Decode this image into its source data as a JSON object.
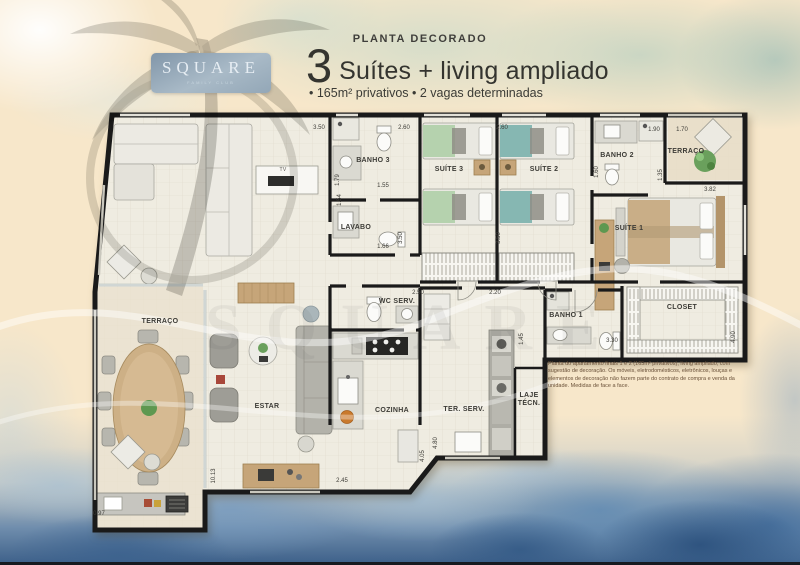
{
  "logo": {
    "brand": "SQUARE",
    "tagline": "FAMILY CLUB"
  },
  "header": {
    "kicker": "PLANTA DECORADO",
    "big_number": "3",
    "title": "Suítes + living ampliado",
    "features": "• 165m² privativos • 2 vagas determinadas"
  },
  "watermark": {
    "text": "SQUARE"
  },
  "colors": {
    "wall": "#1a1a1a",
    "floor": "#efece1",
    "badge": "#8a9cae",
    "water_blue": "#5d8cb8",
    "wood": "#c6a579",
    "suite3_accent": "#b5d2ae",
    "suite2_accent": "#86b7b2"
  },
  "plan": {
    "rooms": [
      {
        "label": "TERRAÇO",
        "x": 160,
        "y": 322
      },
      {
        "label": "ESTAR",
        "x": 267,
        "y": 407
      },
      {
        "label": "COZINHA",
        "x": 392,
        "y": 411
      },
      {
        "label": "TER. SERV.",
        "x": 464,
        "y": 410
      },
      {
        "label": "LAJE\nTÉCN.",
        "x": 529,
        "y": 400
      },
      {
        "label": "WC SERV.",
        "x": 397,
        "y": 302
      },
      {
        "label": "BANHO 1",
        "x": 566,
        "y": 316
      },
      {
        "label": "BANHO 3",
        "x": 373,
        "y": 161
      },
      {
        "label": "LAVABO",
        "x": 356,
        "y": 228
      },
      {
        "label": "SUÍTE 3",
        "x": 449,
        "y": 170
      },
      {
        "label": "SUÍTE 2",
        "x": 544,
        "y": 170
      },
      {
        "label": "BANHO 2",
        "x": 617,
        "y": 156
      },
      {
        "label": "SUÍTE 1",
        "x": 629,
        "y": 229
      },
      {
        "label": "TERRAÇO",
        "x": 686,
        "y": 152
      },
      {
        "label": "CLOSET",
        "x": 682,
        "y": 308
      },
      {
        "label": "TV",
        "x": 283,
        "y": 171,
        "small": true
      }
    ],
    "dimensions": [
      {
        "v": "3.50",
        "x": 319,
        "y": 128
      },
      {
        "v": "2.60",
        "x": 404,
        "y": 128
      },
      {
        "v": "2.60",
        "x": 502,
        "y": 128
      },
      {
        "v": "1.90",
        "x": 654,
        "y": 130
      },
      {
        "v": "1.70",
        "x": 682,
        "y": 130
      },
      {
        "v": "1.55",
        "x": 383,
        "y": 186
      },
      {
        "v": "1.79",
        "x": 338,
        "y": 180,
        "vert": true
      },
      {
        "v": "1.54",
        "x": 340,
        "y": 200,
        "vert": true
      },
      {
        "v": "1.66",
        "x": 383,
        "y": 247
      },
      {
        "v": "3.50",
        "x": 401,
        "y": 238,
        "vert": true
      },
      {
        "v": "3.50",
        "x": 499,
        "y": 238,
        "vert": true
      },
      {
        "v": "1.60",
        "x": 597,
        "y": 172,
        "vert": true
      },
      {
        "v": "1.35",
        "x": 661,
        "y": 175,
        "vert": true
      },
      {
        "v": "3.82",
        "x": 710,
        "y": 190
      },
      {
        "v": "4.90",
        "x": 734,
        "y": 337,
        "vert": true
      },
      {
        "v": "3.30",
        "x": 612,
        "y": 341
      },
      {
        "v": "2.50",
        "x": 418,
        "y": 293
      },
      {
        "v": "2.20",
        "x": 495,
        "y": 293
      },
      {
        "v": "1.45",
        "x": 522,
        "y": 339,
        "vert": true
      },
      {
        "v": "2.45",
        "x": 342,
        "y": 481
      },
      {
        "v": "4.05",
        "x": 423,
        "y": 456,
        "vert": true
      },
      {
        "v": "4.80",
        "x": 436,
        "y": 443,
        "vert": true
      },
      {
        "v": "10.13",
        "x": 214,
        "y": 476,
        "vert": true
      },
      {
        "v": "0.97",
        "x": 99,
        "y": 514
      }
    ],
    "disclaimer": "Planta do apartamento finais 1 e 2 (165m² privativos), living ampliado, com sugestão de decoração. Os móveis, eletrodomésticos, eletrônicos, louças e elementos de decoração não fazem parte do contrato de compra e venda da unidade. Medidas de face a face."
  }
}
